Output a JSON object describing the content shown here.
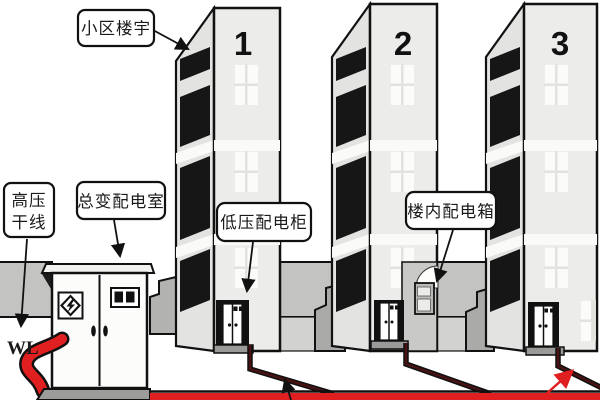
{
  "diagram": {
    "title_hint": "residential district power distribution diagram",
    "labels": {
      "community_buildings": "小区楼宇",
      "hv_trunk_line_1": "高压",
      "hv_trunk_line_2": "干线",
      "main_transformer_room": "总变配电室",
      "lv_distribution_cabinet": "低压配电柜",
      "indoor_distribution_box": "楼内配电箱",
      "cable_code": "WL"
    },
    "buildings": [
      {
        "number": "1"
      },
      {
        "number": "2"
      },
      {
        "number": "3"
      }
    ],
    "colors": {
      "main_line_red": "#e02020",
      "branch_cable_dark": "#4a1212",
      "wall_gray": "#c3c3c1",
      "courtyard_gray": "#d2d2d0",
      "porch_gray": "#aaaaa8",
      "building_front": "#ececea",
      "building_side": "#e3e3e1",
      "outline_black": "#111111"
    }
  }
}
